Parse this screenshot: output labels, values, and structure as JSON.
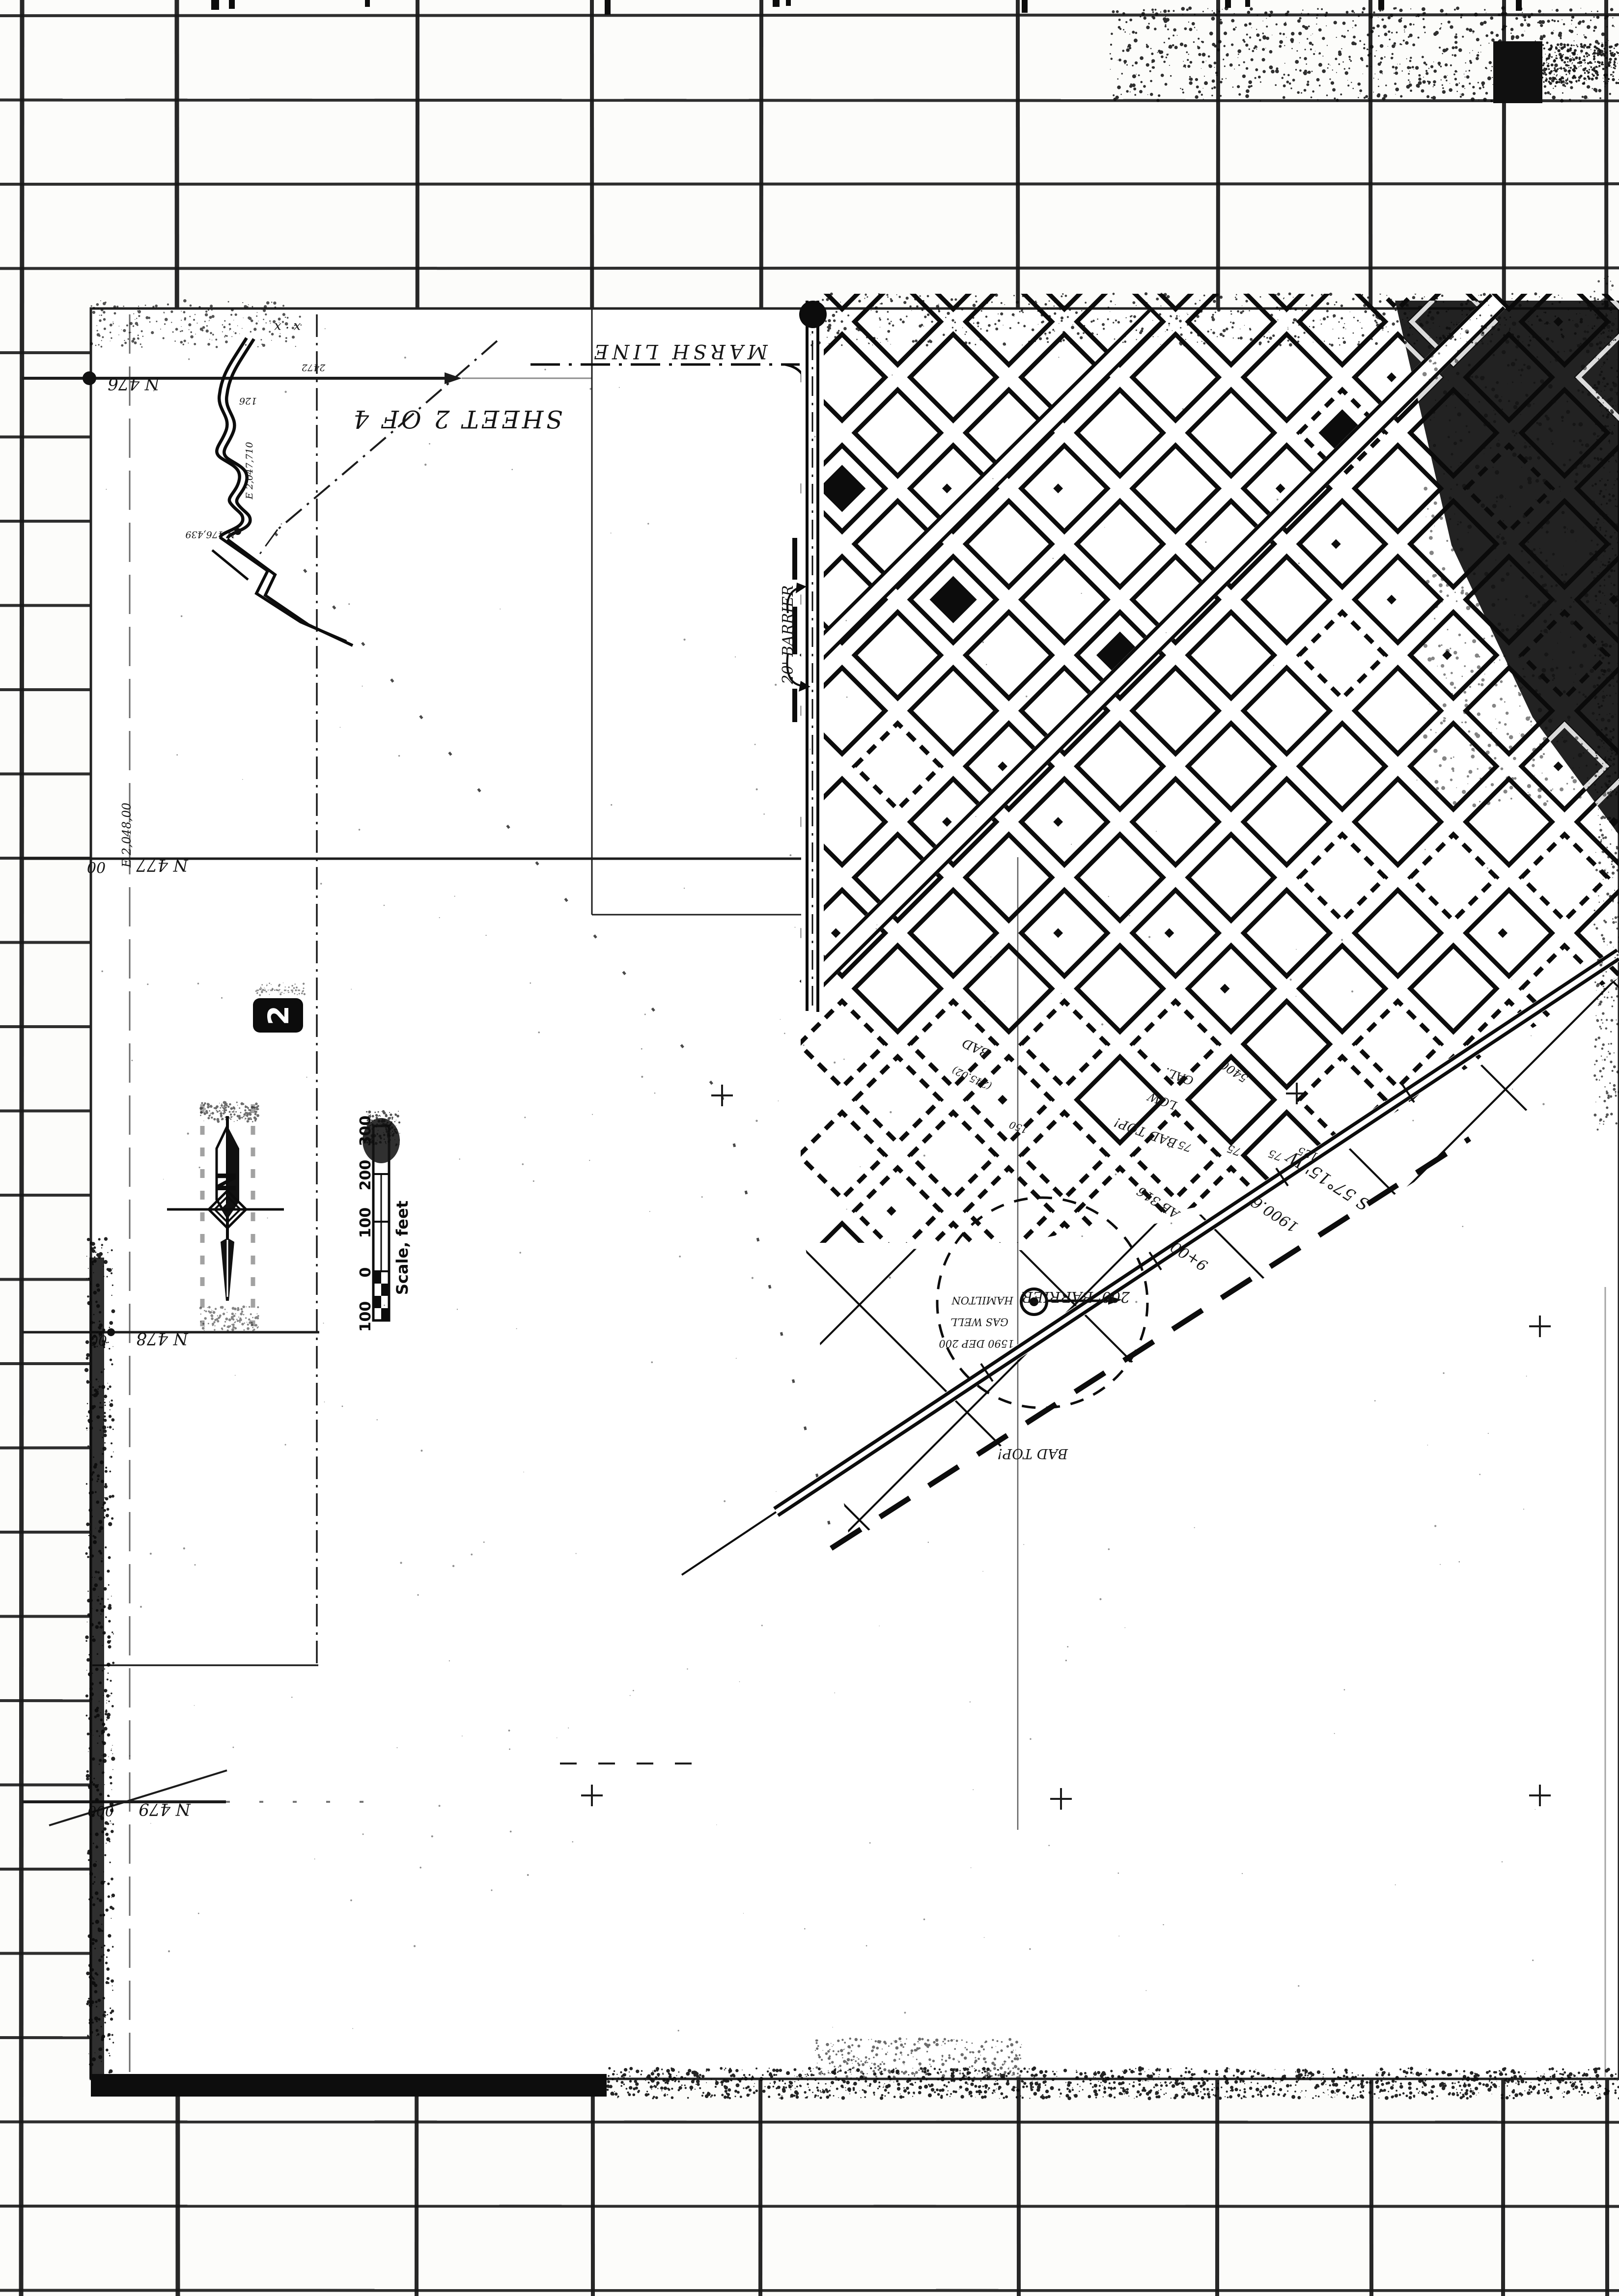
{
  "document": {
    "kind": "scanned-survey-map-sheet",
    "sheet_note": "SHEET 2 OF 4",
    "stamp_number": "2",
    "corner_marks": "x  ·  x"
  },
  "compass": {
    "north_label": "N"
  },
  "scale_bar": {
    "caption": "Scale, feet",
    "ticks": [
      "300",
      "200",
      "100",
      "0",
      "100"
    ]
  },
  "grid": {
    "northings": [
      "N 476",
      "N 477",
      "N 478",
      "N 479"
    ],
    "suffix_477": "00",
    "suffix_478": "00",
    "suffix_479": "000",
    "easting_477": "E 2,048,00"
  },
  "marsh": {
    "label": "MARSH LINE"
  },
  "barriers": {
    "b200": "200' BARRIER",
    "b20": "20' BARRIER"
  },
  "well": {
    "line1": "HAMILTON",
    "line2": "GAS WELL",
    "line3": "1590  DEP 200"
  },
  "survey": {
    "bearing": "S 57°15' W",
    "distance": "1900.6'",
    "station": "9+00",
    "ref": "AB 316",
    "area": "(245.02)"
  },
  "road_notes": {
    "n1": "GAL.",
    "n2": "LOW",
    "n3": "BAD TOP!",
    "n4": "BAD",
    "n5": "BAD TOP!"
  },
  "blocks": {
    "b150": "150",
    "b75a": "75",
    "b75b": "75",
    "b75c": "75",
    "b125": "125",
    "b5400": "5400"
  },
  "monument": {
    "n": "N 476,439",
    "e": "E 2,047,710",
    "elev": "126",
    "misc": "2472"
  }
}
